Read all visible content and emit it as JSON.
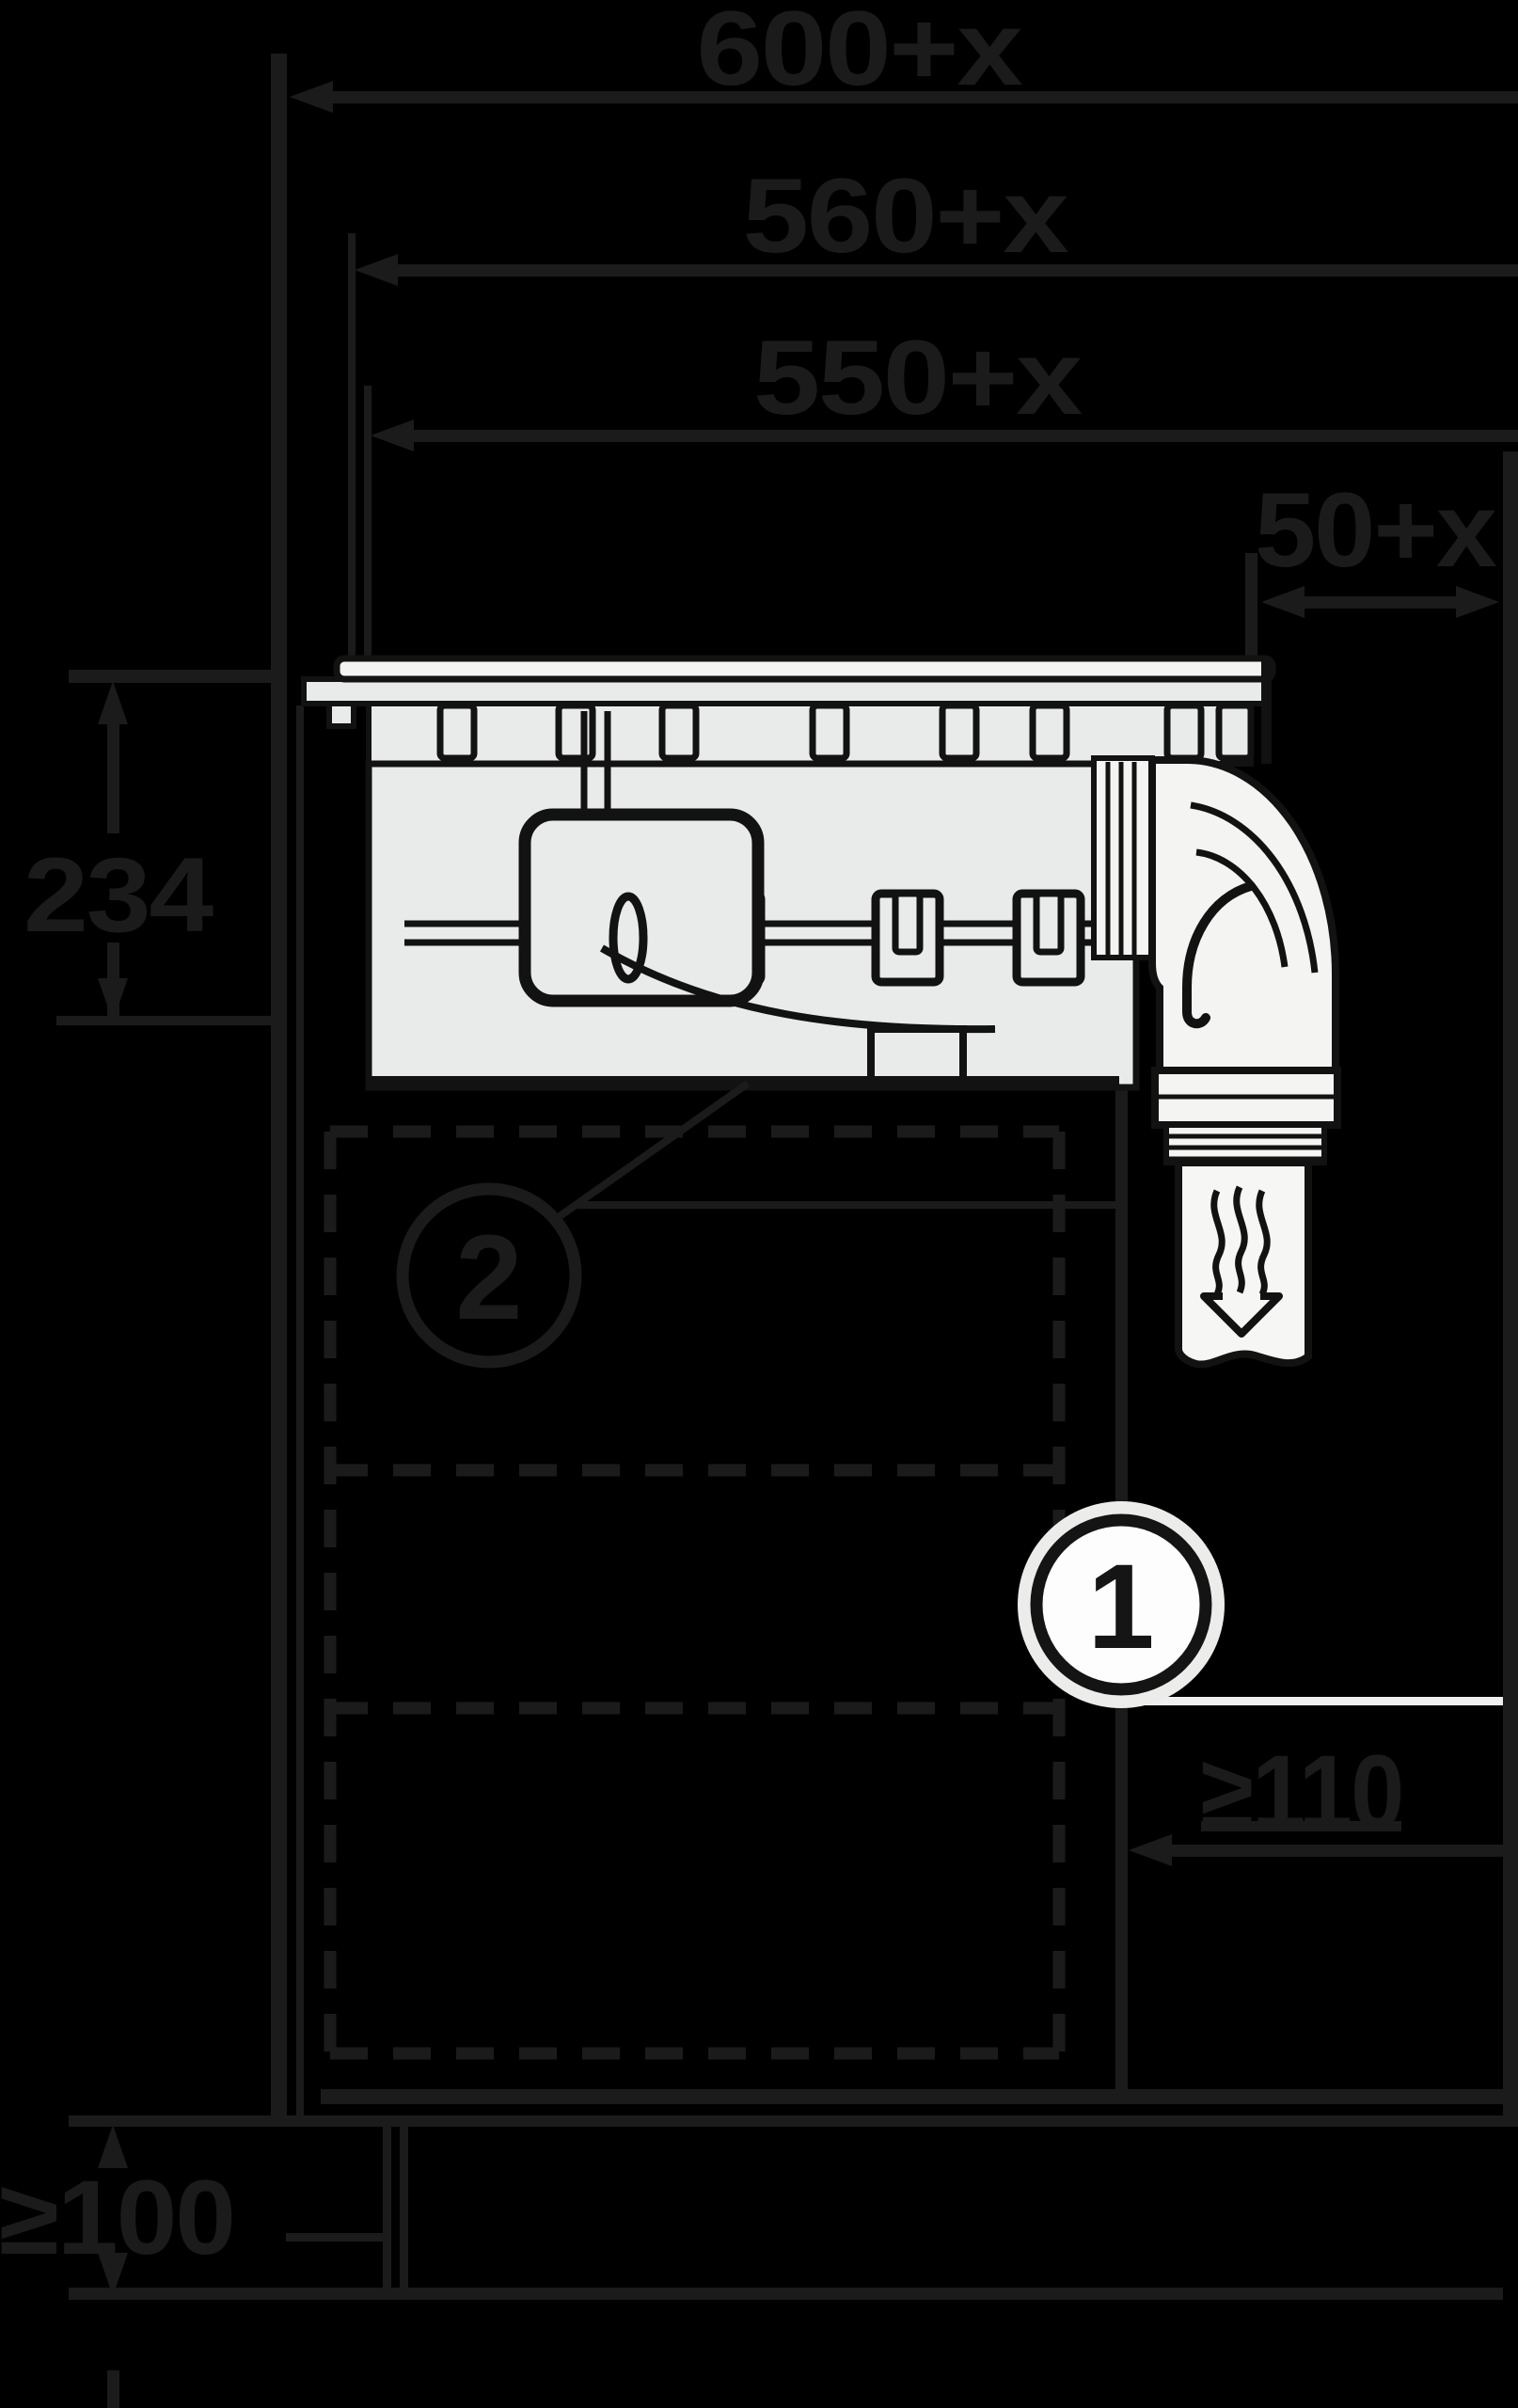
{
  "diagram": {
    "type": "appliance installation cross-section drawing",
    "labels": {
      "dim_600": "600+x",
      "dim_560": "560+x",
      "dim_550": "550+x",
      "dim_50": "50+x",
      "dim_234": "234",
      "dim_110": "≥110",
      "dim_100": "≥100",
      "callout_1": "1",
      "callout_2": "2"
    },
    "colors": {
      "background": "#000000",
      "dimension_line": "#1b1b1b",
      "drawing_outline": "#121212",
      "appliance_fill": "#e9eaea",
      "duct_fill": "#f4f4f2",
      "callout_fill": "#fdfdfd",
      "white_leader": "#efefef"
    }
  }
}
